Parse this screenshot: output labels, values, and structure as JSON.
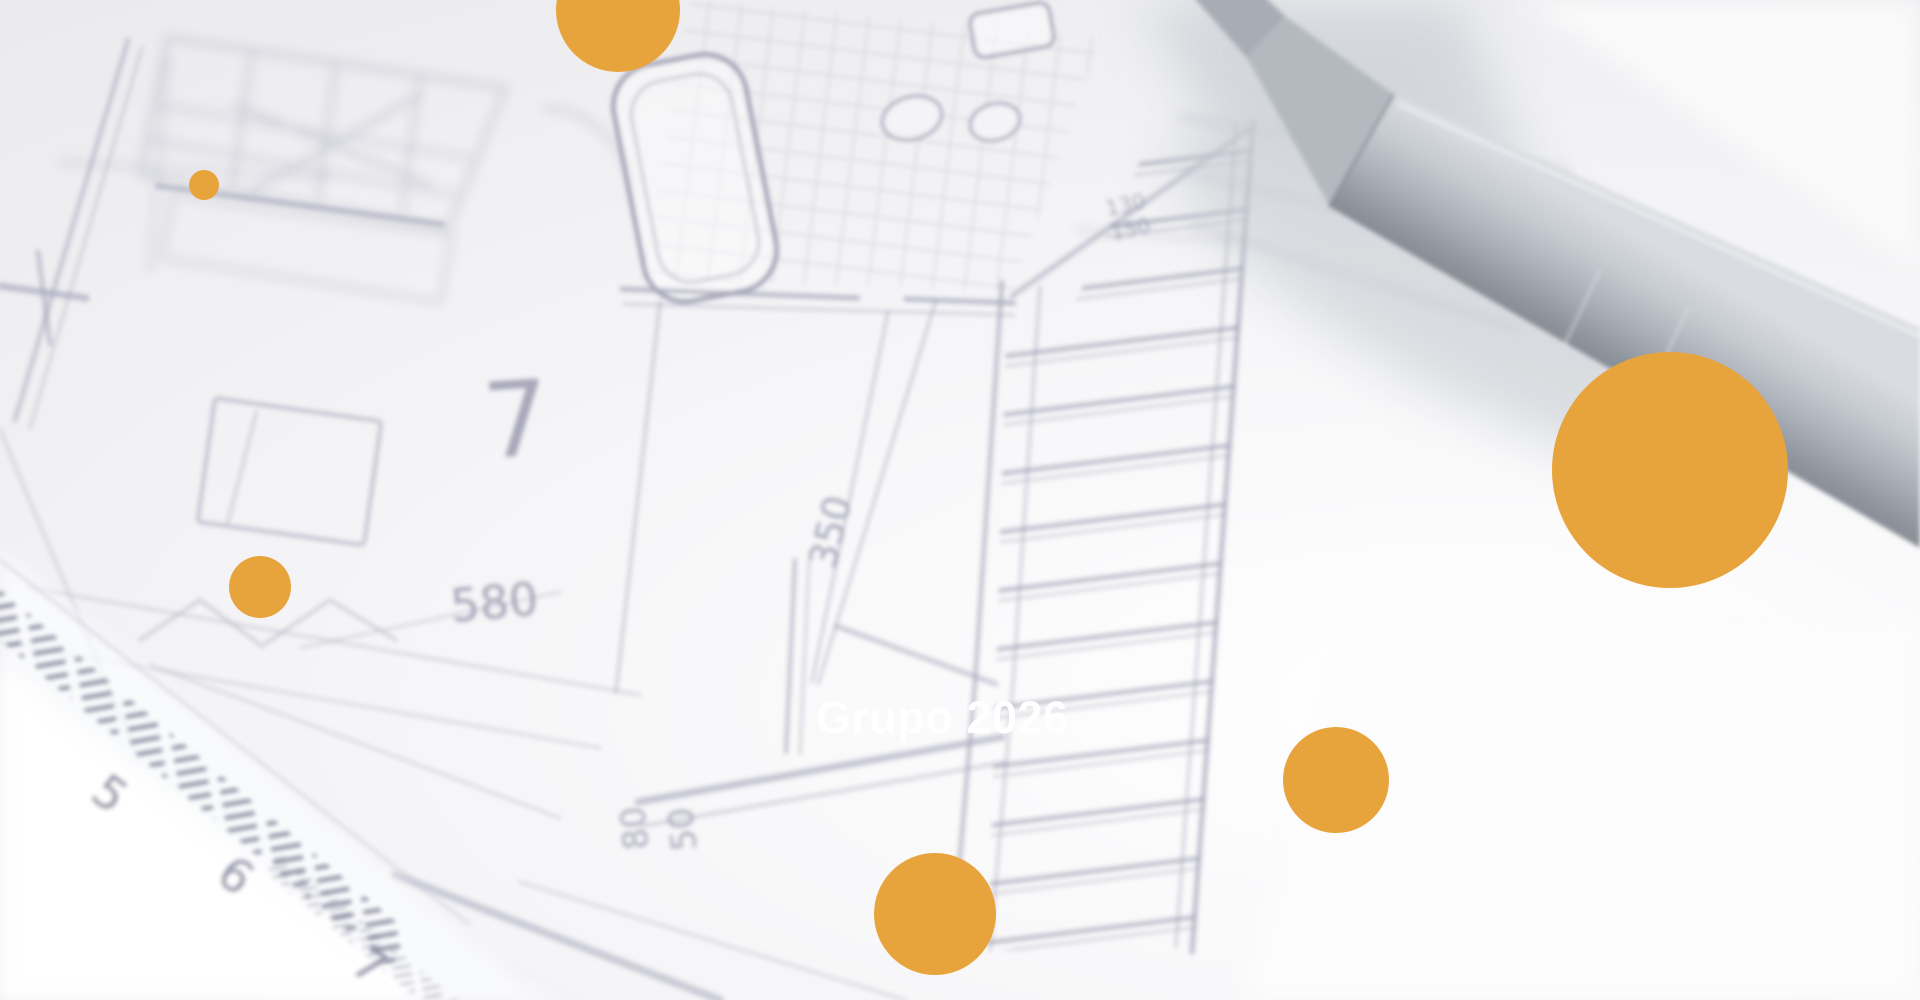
{
  "page": {
    "title": "Grupo 2026"
  },
  "hero": {
    "heading": "Grupo 2026"
  },
  "colors": {
    "accent": "#E8A43C",
    "paper": "#F2F2F5",
    "blueprint_line": "#8C8CA6",
    "pen_gray": "#A9AFB8",
    "heading_text": "#FFFFFF"
  },
  "blueprint": {
    "labels": {
      "room_number": "7",
      "dim_580": "580",
      "dim_350": "350",
      "dim_80": "80",
      "dim_50": "50",
      "dim_130": "130",
      "dim_150": "150"
    }
  },
  "ruler": {
    "numbers": {
      "n5": "5",
      "n6": "6",
      "n7": "7"
    }
  },
  "decorative_circles": [
    {
      "cx": 618,
      "cy": 10,
      "r": 62
    },
    {
      "cx": 204,
      "cy": 185,
      "r": 15
    },
    {
      "cx": 260,
      "cy": 587,
      "r": 31
    },
    {
      "cx": 1670,
      "cy": 470,
      "r": 118
    },
    {
      "cx": 1336,
      "cy": 780,
      "r": 53
    },
    {
      "cx": 935,
      "cy": 914,
      "r": 61
    }
  ]
}
